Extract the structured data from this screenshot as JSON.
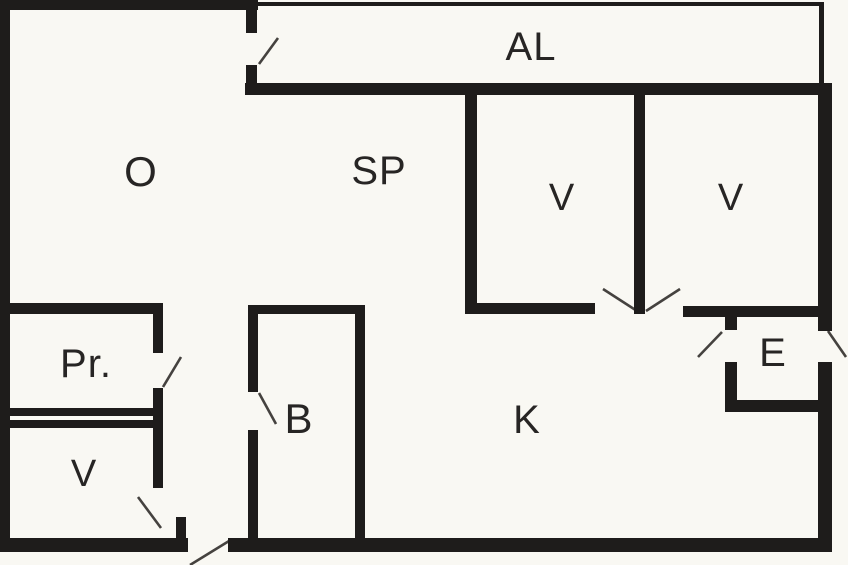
{
  "canvas": {
    "width": 848,
    "height": 565,
    "background": "#f9f8f3",
    "wall_color": "#1e1c1b",
    "swing_color": "#45423f",
    "label_color": "#272524"
  },
  "rooms": [
    {
      "id": "al",
      "label": "AL",
      "cx": 531,
      "cy": 47,
      "size": 40
    },
    {
      "id": "o",
      "label": "O",
      "cx": 141,
      "cy": 172,
      "size": 42
    },
    {
      "id": "sp",
      "label": "SP",
      "cx": 379,
      "cy": 171,
      "size": 40
    },
    {
      "id": "v-top-1",
      "label": "V",
      "cx": 562,
      "cy": 198,
      "size": 38
    },
    {
      "id": "v-top-2",
      "label": "V",
      "cx": 731,
      "cy": 198,
      "size": 38
    },
    {
      "id": "pr",
      "label": "Pr.",
      "cx": 86,
      "cy": 364,
      "size": 40
    },
    {
      "id": "v-bottom",
      "label": "V",
      "cx": 84,
      "cy": 474,
      "size": 38
    },
    {
      "id": "b",
      "label": "B",
      "cx": 299,
      "cy": 419,
      "size": 42
    },
    {
      "id": "k",
      "label": "K",
      "cx": 527,
      "cy": 420,
      "size": 40
    },
    {
      "id": "e",
      "label": "E",
      "cx": 773,
      "cy": 353,
      "size": 40
    }
  ],
  "walls": [
    {
      "name": "outer-top-wall",
      "x": 0,
      "y": 0,
      "w": 258,
      "h": 10
    },
    {
      "name": "outer-left-wall",
      "x": 0,
      "y": 0,
      "w": 10,
      "h": 552
    },
    {
      "name": "outer-bottom-wall-left",
      "x": 0,
      "y": 538,
      "w": 188,
      "h": 14
    },
    {
      "name": "outer-bottom-wall-right",
      "x": 228,
      "y": 538,
      "w": 604,
      "h": 14
    },
    {
      "name": "outer-right-wall-upper",
      "x": 818,
      "y": 83,
      "w": 14,
      "h": 248
    },
    {
      "name": "outer-right-wall-lower",
      "x": 818,
      "y": 362,
      "w": 14,
      "h": 190
    },
    {
      "name": "balcony-bottom-wall",
      "x": 245,
      "y": 83,
      "w": 587,
      "h": 12
    },
    {
      "name": "balcony-top-wall-thin",
      "x": 257,
      "y": 2,
      "w": 566,
      "h": 4
    },
    {
      "name": "balcony-right-wall-thin",
      "x": 819,
      "y": 2,
      "w": 5,
      "h": 83
    },
    {
      "name": "balcony-divider-upper",
      "x": 246,
      "y": 0,
      "w": 11,
      "h": 33
    },
    {
      "name": "balcony-divider-lower",
      "x": 246,
      "y": 65,
      "w": 11,
      "h": 30
    },
    {
      "name": "sp-v1-divider",
      "x": 465,
      "y": 95,
      "w": 12,
      "h": 218
    },
    {
      "name": "v1-v2-divider",
      "x": 634,
      "y": 95,
      "w": 11,
      "h": 219
    },
    {
      "name": "v1-bottom-wall",
      "x": 465,
      "y": 303,
      "w": 130,
      "h": 11
    },
    {
      "name": "v2-bottom-e-top-wall",
      "x": 683,
      "y": 306,
      "w": 149,
      "h": 11
    },
    {
      "name": "pr-top-wall",
      "x": 0,
      "y": 303,
      "w": 163,
      "h": 11
    },
    {
      "name": "pr-right-wall-upper",
      "x": 153,
      "y": 303,
      "w": 10,
      "h": 50
    },
    {
      "name": "pr-right-wall-lower",
      "x": 153,
      "y": 388,
      "w": 10,
      "h": 100
    },
    {
      "name": "pr-bottom-wall",
      "x": 0,
      "y": 408,
      "w": 163,
      "h": 8
    },
    {
      "name": "v-bottom-top-wall",
      "x": 6,
      "y": 420,
      "w": 157,
      "h": 8
    },
    {
      "name": "v-bottom-door-stub",
      "x": 176,
      "y": 517,
      "w": 10,
      "h": 23
    },
    {
      "name": "b-top-wall",
      "x": 248,
      "y": 305,
      "w": 115,
      "h": 9
    },
    {
      "name": "b-left-wall-upper",
      "x": 248,
      "y": 305,
      "w": 10,
      "h": 87
    },
    {
      "name": "b-left-wall-lower",
      "x": 248,
      "y": 430,
      "w": 10,
      "h": 108
    },
    {
      "name": "b-right-wall",
      "x": 355,
      "y": 305,
      "w": 10,
      "h": 233
    },
    {
      "name": "e-left-wall-stub",
      "x": 725,
      "y": 317,
      "w": 12,
      "h": 13
    },
    {
      "name": "e-left-wall-lower",
      "x": 725,
      "y": 362,
      "w": 12,
      "h": 50
    },
    {
      "name": "e-bottom-wall",
      "x": 725,
      "y": 400,
      "w": 100,
      "h": 12
    }
  ],
  "door_swings": [
    {
      "name": "door-swing-balcony",
      "x1": 259,
      "y1": 64,
      "x2": 278,
      "y2": 38
    },
    {
      "name": "door-swing-v1",
      "x1": 603,
      "y1": 289,
      "x2": 637,
      "y2": 311
    },
    {
      "name": "door-swing-v2",
      "x1": 646,
      "y1": 311,
      "x2": 680,
      "y2": 289
    },
    {
      "name": "door-swing-pr",
      "x1": 163,
      "y1": 387,
      "x2": 181,
      "y2": 357
    },
    {
      "name": "door-swing-v-bottom",
      "x1": 138,
      "y1": 497,
      "x2": 161,
      "y2": 528
    },
    {
      "name": "door-swing-b",
      "x1": 259,
      "y1": 393,
      "x2": 276,
      "y2": 424
    },
    {
      "name": "door-swing-e-inner",
      "x1": 722,
      "y1": 332,
      "x2": 698,
      "y2": 357
    },
    {
      "name": "door-swing-e-exterior",
      "x1": 828,
      "y1": 331,
      "x2": 846,
      "y2": 357
    },
    {
      "name": "door-swing-main-entrance",
      "x1": 229,
      "y1": 541,
      "x2": 190,
      "y2": 565
    }
  ]
}
